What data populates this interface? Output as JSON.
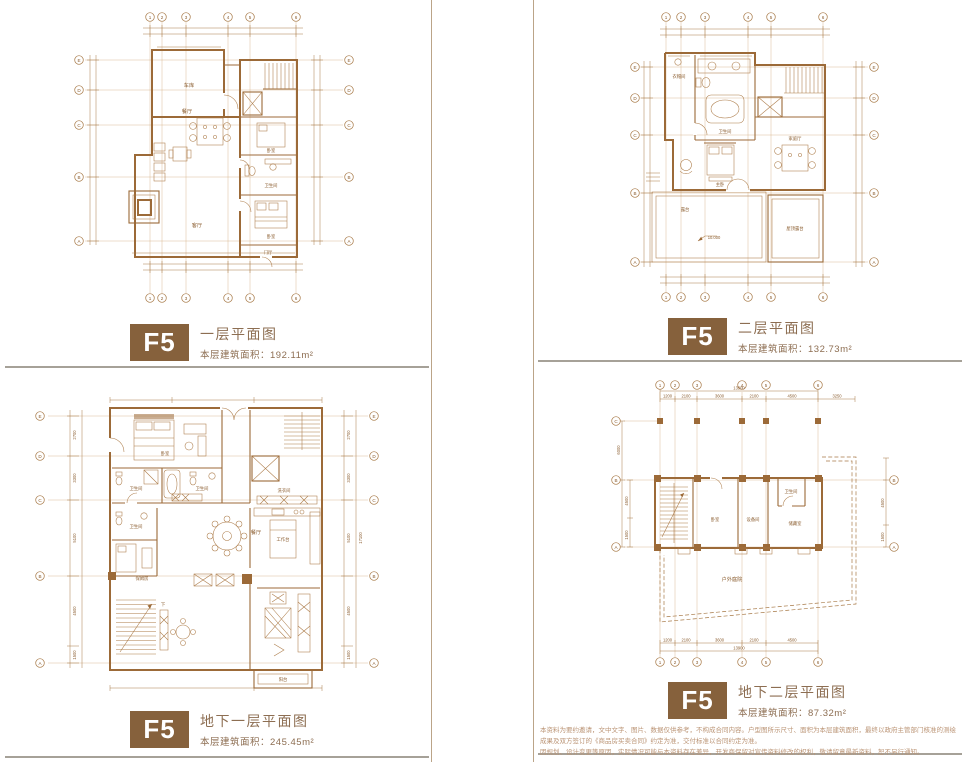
{
  "page": {
    "accent": "#86613c",
    "line_color": "#9c6a38",
    "rule_color": "#a6a198"
  },
  "panels": {
    "floor1": {
      "badge": "F5",
      "title": "一层平面图",
      "area_label": "本层建筑面积：",
      "area_value": "192.11m²"
    },
    "floor2": {
      "badge": "F5",
      "title": "二层平面图",
      "area_label": "本层建筑面积：",
      "area_value": "132.73m²"
    },
    "basement1": {
      "badge": "F5",
      "title": "地下一层平面图",
      "area_label": "本层建筑面积：",
      "area_value": "245.45m²"
    },
    "basement2": {
      "badge": "F5",
      "title": "地下二层平面图",
      "area_label": "本层建筑面积：",
      "area_value": "87.32m²"
    }
  },
  "disclaimer": {
    "line1": "本资料为要约邀请，文中文字、图片、数据仅供参考，不构成合同内容。户型图所示尺寸、面积为本层建筑面积，最终以政府主管部门核准的测绘成果及双方签订的《商品房买卖合同》约定为准，交付标准以合同约定为准。",
    "line2": "因规划、设计变更等原因，实际情况可能与本资料存在差异，开发商保留对宣传资料修改的权利，敬请留意最新资料，恕不另行通知。"
  },
  "plans": {
    "floor1": {
      "axes_cols": [
        "1",
        "2",
        "3",
        "4",
        "5",
        "6"
      ],
      "axes_rows": [
        "E",
        "D",
        "C",
        "B",
        "A"
      ],
      "rooms": {
        "garage": "车库",
        "dining": "餐厅",
        "living": "客厅",
        "bedroom": "卧室",
        "bedroom2": "卧室",
        "bath": "卫生间",
        "foyer": "门厅"
      }
    },
    "floor2": {
      "axes_cols": [
        "1",
        "2",
        "3",
        "4",
        "5",
        "6"
      ],
      "axes_rows": [
        "E",
        "D",
        "C",
        "B",
        "A"
      ],
      "rooms": {
        "closet": "衣帽间",
        "bath": "卫生间",
        "master": "主卧",
        "family": "家庭厅",
        "terrace": "露台",
        "roof_terrace": "屋顶露台"
      },
      "elevation": "10.000"
    },
    "basement1": {
      "axes_rows": [
        "E",
        "D",
        "C",
        "B",
        "A"
      ],
      "rooms": {
        "bedroom": "卧室",
        "bath1": "卫生间",
        "bath2": "卫生间",
        "bath3": "卫生间",
        "nanny": "保姆房",
        "laundry": "洗衣间",
        "dining": "餐厅",
        "worktop": "工作台",
        "stairs_down": "下",
        "balcony": "阳台"
      },
      "dims_left": [
        "2700",
        "3300",
        "5100",
        "4500",
        "1500"
      ],
      "dims_right": [
        "2700",
        "3300",
        "5100",
        "4500",
        "1500"
      ],
      "dim_total": "17100"
    },
    "basement2": {
      "axes_cols": [
        "1",
        "2",
        "3",
        "4",
        "5",
        "6"
      ],
      "axes_rows_left": [
        "C",
        "B",
        "A"
      ],
      "axes_rows_right": [
        "B",
        "A"
      ],
      "rooms": {
        "bedroom": "卧室",
        "equipment": "设备间",
        "storage": "储藏室",
        "bath": "卫生间",
        "courtyard": "户外庭院"
      },
      "dims_top": [
        "1200",
        "2100",
        "3600",
        "2100",
        "4500"
      ],
      "dim_extra": "3250",
      "dim_total": "13900",
      "dims_left": [
        "6000",
        "4500",
        "1500"
      ],
      "dims_right": [
        "4500",
        "1500"
      ]
    }
  }
}
